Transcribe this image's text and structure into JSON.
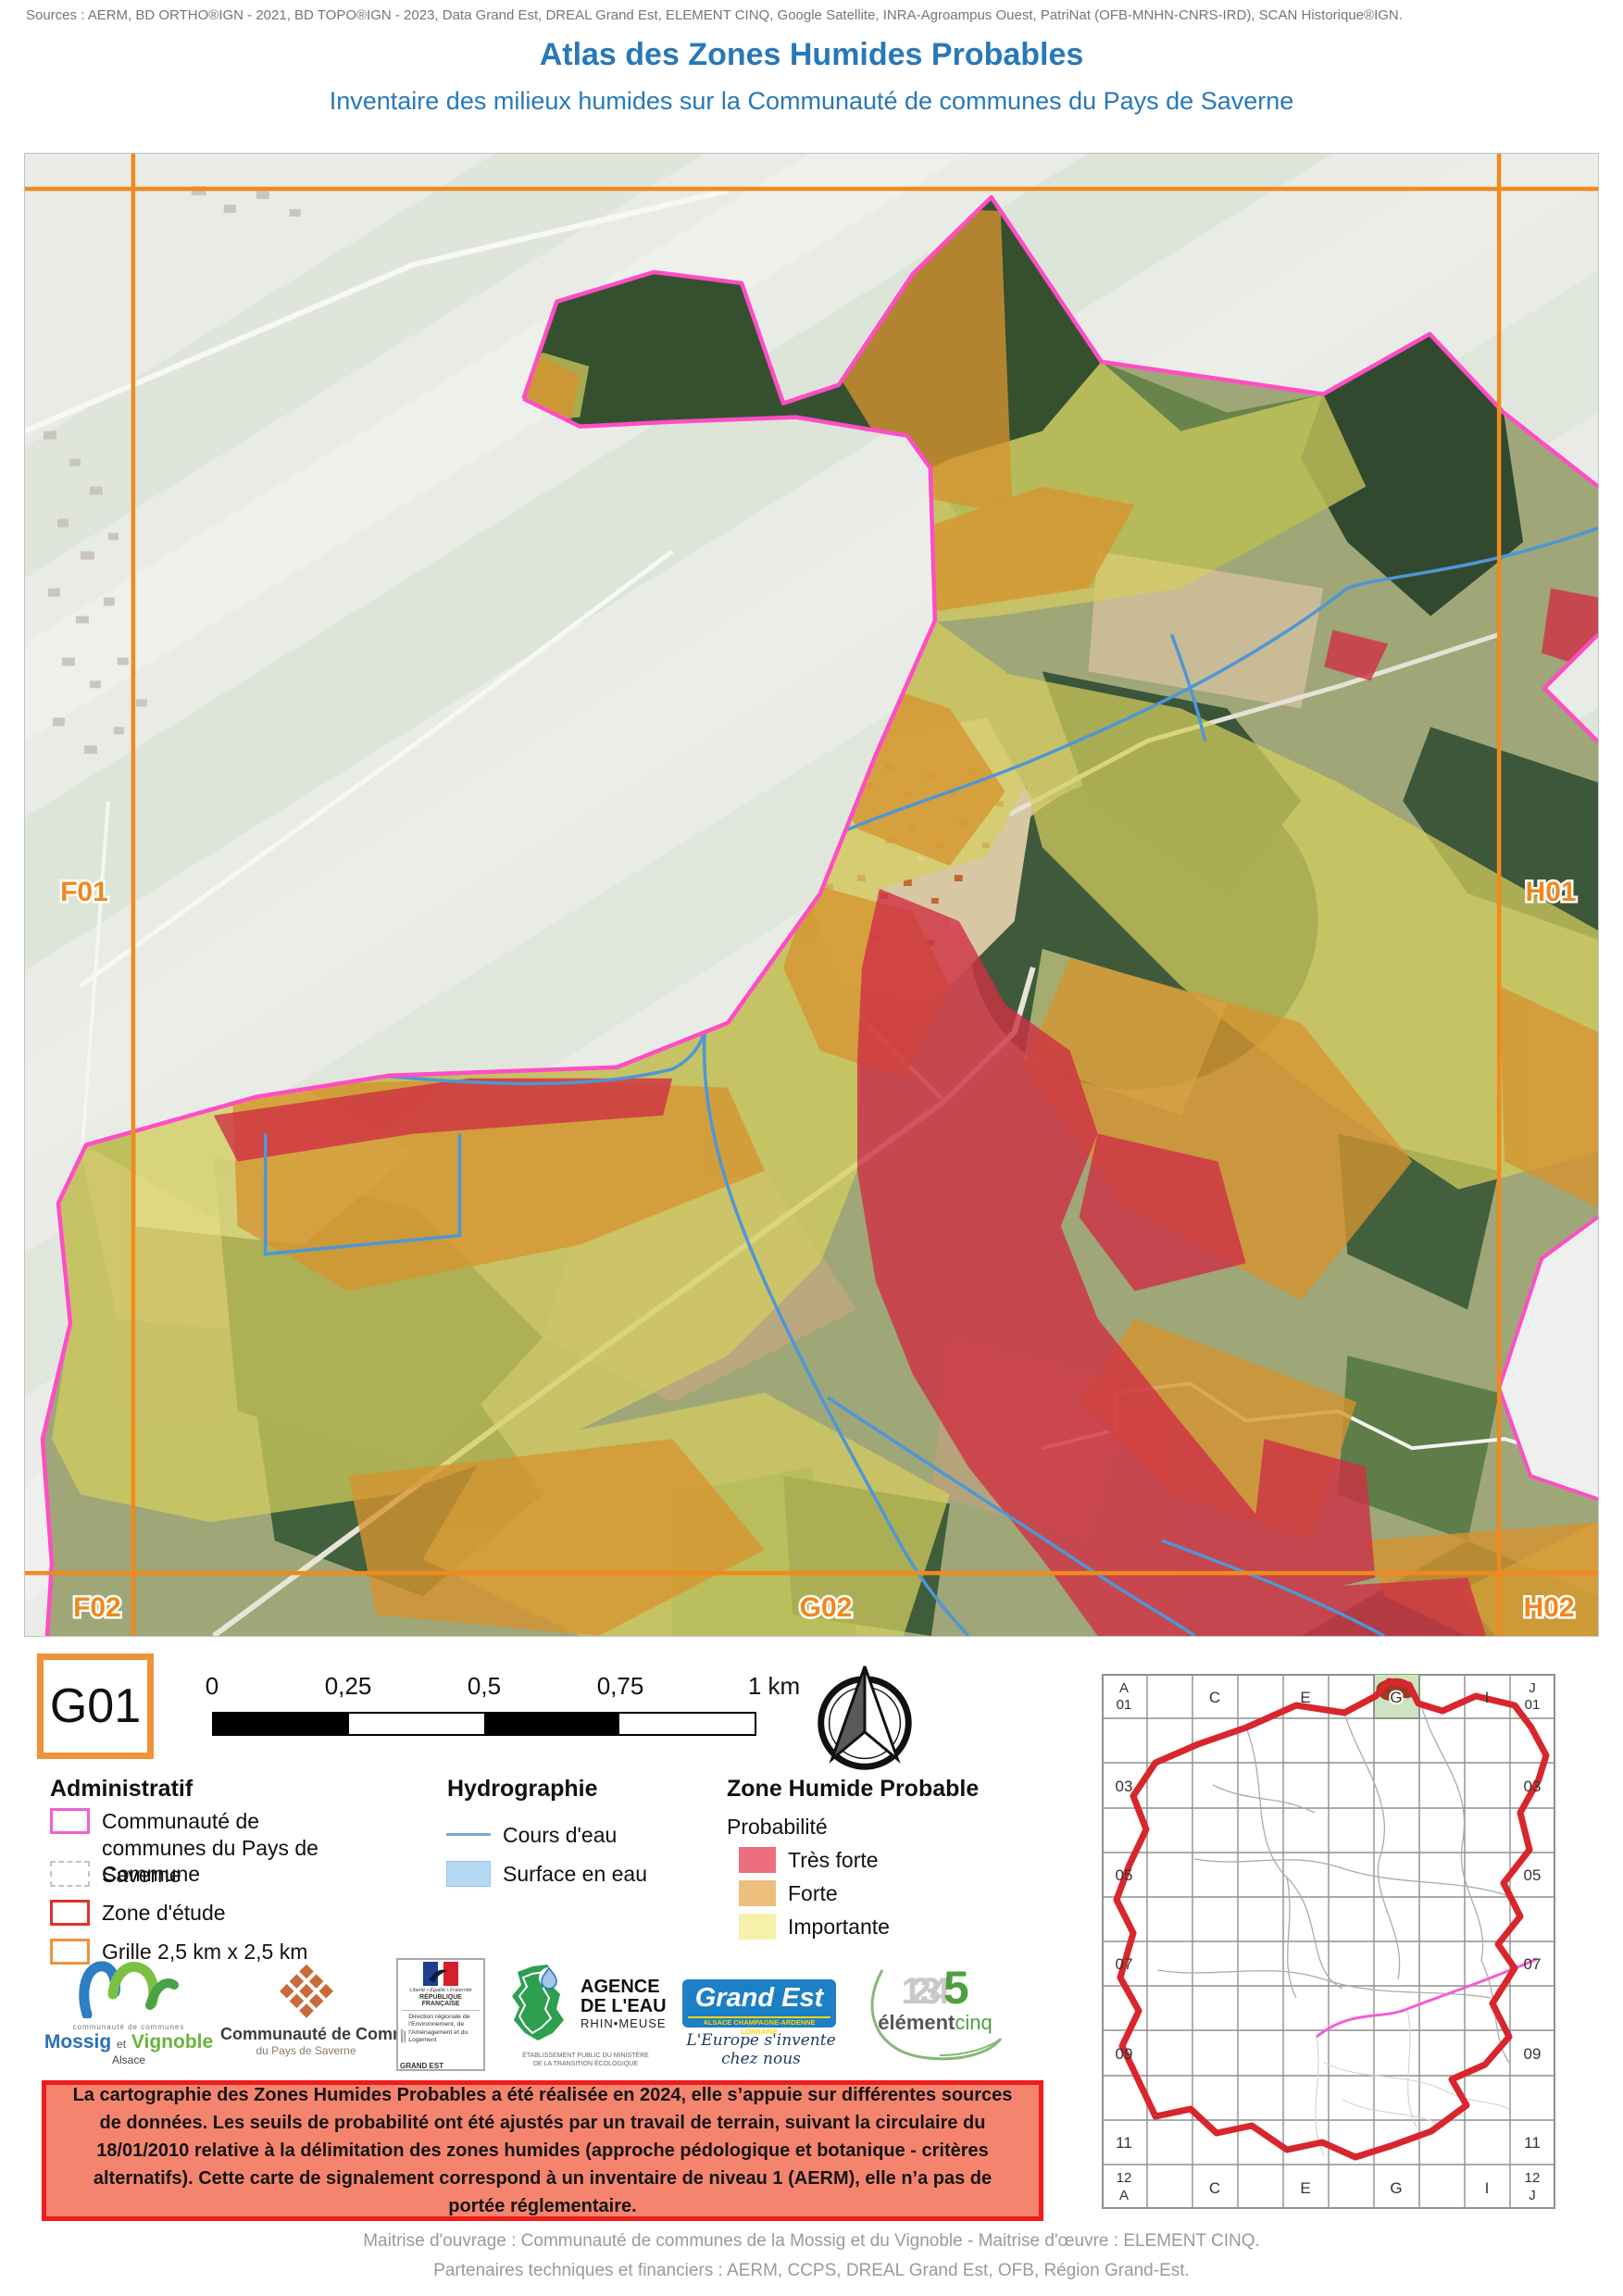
{
  "header": {
    "sources": "Sources : AERM, BD ORTHO®IGN - 2021, BD TOPO®IGN - 2023, Data Grand Est, DREAL Grand Est, ELEMENT CINQ, Google Satellite, INRA-Agroampus Ouest, PatriNat (OFB-MNHN-CNRS-IRD), SCAN Historique®IGN.",
    "title": "Atlas des Zones Humides Probables",
    "subtitle": "Inventaire des milieux humides sur la Communauté de communes du Pays de Saverne"
  },
  "map": {
    "cell_ref": "G01",
    "grid_labels": {
      "f01": "F01",
      "h01": "H01",
      "f02": "F02",
      "g02": "G02",
      "h02": "H02"
    }
  },
  "scalebar": {
    "ticks": [
      "0",
      "0,25",
      "0,5",
      "0,75",
      "1 km"
    ]
  },
  "legend": {
    "administratif": {
      "title": "Administratif",
      "items": [
        {
          "label": "Communauté de communes du Pays de Saverne"
        },
        {
          "label": "Commune"
        },
        {
          "label": "Zone d'étude"
        },
        {
          "label": "Grille 2,5 km x 2,5 km"
        }
      ]
    },
    "hydrographie": {
      "title": "Hydrographie",
      "items": [
        {
          "label": "Cours d'eau"
        },
        {
          "label": "Surface en eau"
        }
      ]
    },
    "zhp": {
      "title": "Zone Humide Probable",
      "subtitle": "Probabilité",
      "items": [
        {
          "label": "Très forte",
          "color": "#ed6e7c"
        },
        {
          "label": "Forte",
          "color": "#ecbf7d"
        },
        {
          "label": "Importante",
          "color": "#f5f0aa"
        }
      ]
    }
  },
  "logos": {
    "mossig": {
      "cc": "communauté de communes",
      "w1": "Mossig",
      "w2": "et",
      "w3": "Vignoble",
      "region": "Alsace"
    },
    "ccps": {
      "line1": "Communauté de Communes",
      "line2": "du Pays de Saverne"
    },
    "dreal": {
      "motto": "Liberté • Égalité • Fraternité",
      "rep": "RÉPUBLIQUE FRANÇAISE",
      "dir": "Direction régionale de l'Environnement, de l'Aménagement et du Logement",
      "region": "GRAND EST"
    },
    "aerm": {
      "l1": "AGENCE",
      "l2": "DE L'EAU",
      "l3": "RHIN•MEUSE",
      "sub1": "ÉTABLISSEMENT PUBLIC DU MINISTÈRE",
      "sub2": "DE LA TRANSITION ÉCOLOGIQUE"
    },
    "grandest": {
      "name": "Grand Est",
      "strip": "ALSACE CHAMPAGNE-ARDENNE LORRAINE",
      "slogan": "L'Europe s'invente chez nous"
    },
    "element5": {
      "digits": "1234",
      "five": "5",
      "w1": "élément",
      "w2": "cinq"
    }
  },
  "notice": {
    "text": "La cartographie des Zones Humides Probables a été réalisée en 2024, elle s’appuie sur différentes sources de données. Les seuils de probabilité ont été ajustés par un travail de terrain, suivant la circulaire du 18/01/2010 relative à la délimitation des zones humides (approche pédologique et botanique - critères alternatifs). Cette carte de signalement correspond à un inventaire de niveau 1 (AERM), elle n’a pas de portée réglementaire."
  },
  "minimap": {
    "top": {
      "c0a": "A",
      "c0b": "01",
      "c2": "C",
      "c4": "E",
      "c6": "G",
      "c8": "I",
      "c9a": "J",
      "c9b": "01"
    },
    "rows": [
      "03",
      "05",
      "07",
      "09",
      "11"
    ],
    "bottom": {
      "c0a": "12",
      "c0b": "A",
      "c2": "C",
      "c4": "E",
      "c6": "G",
      "c8": "I",
      "c9a": "12",
      "c9b": "J"
    }
  },
  "footer": {
    "line1": "Maitrise d'ouvrage : Communauté de communes de la Mossig et du Vignoble - Maitrise d'œuvre : ELEMENT CINQ.",
    "line2": "Partenaires techniques et financiers : AERM, CCPS, DREAL Grand Est, OFB, Région Grand-Est."
  },
  "colors": {
    "accent_blue": "#2878b8",
    "grid_orange": "#f2871d",
    "boundary_pink": "#ff4dc6",
    "zone_etude_red": "#e23127",
    "tres_forte": "#ed6e7c",
    "forte": "#ecbf7d",
    "importante": "#f5f0aa",
    "cours_eau": "#74aad8",
    "surface_eau": "#b5d8f2",
    "notice_bg": "#f5846e",
    "notice_border": "#ee1c1c"
  }
}
